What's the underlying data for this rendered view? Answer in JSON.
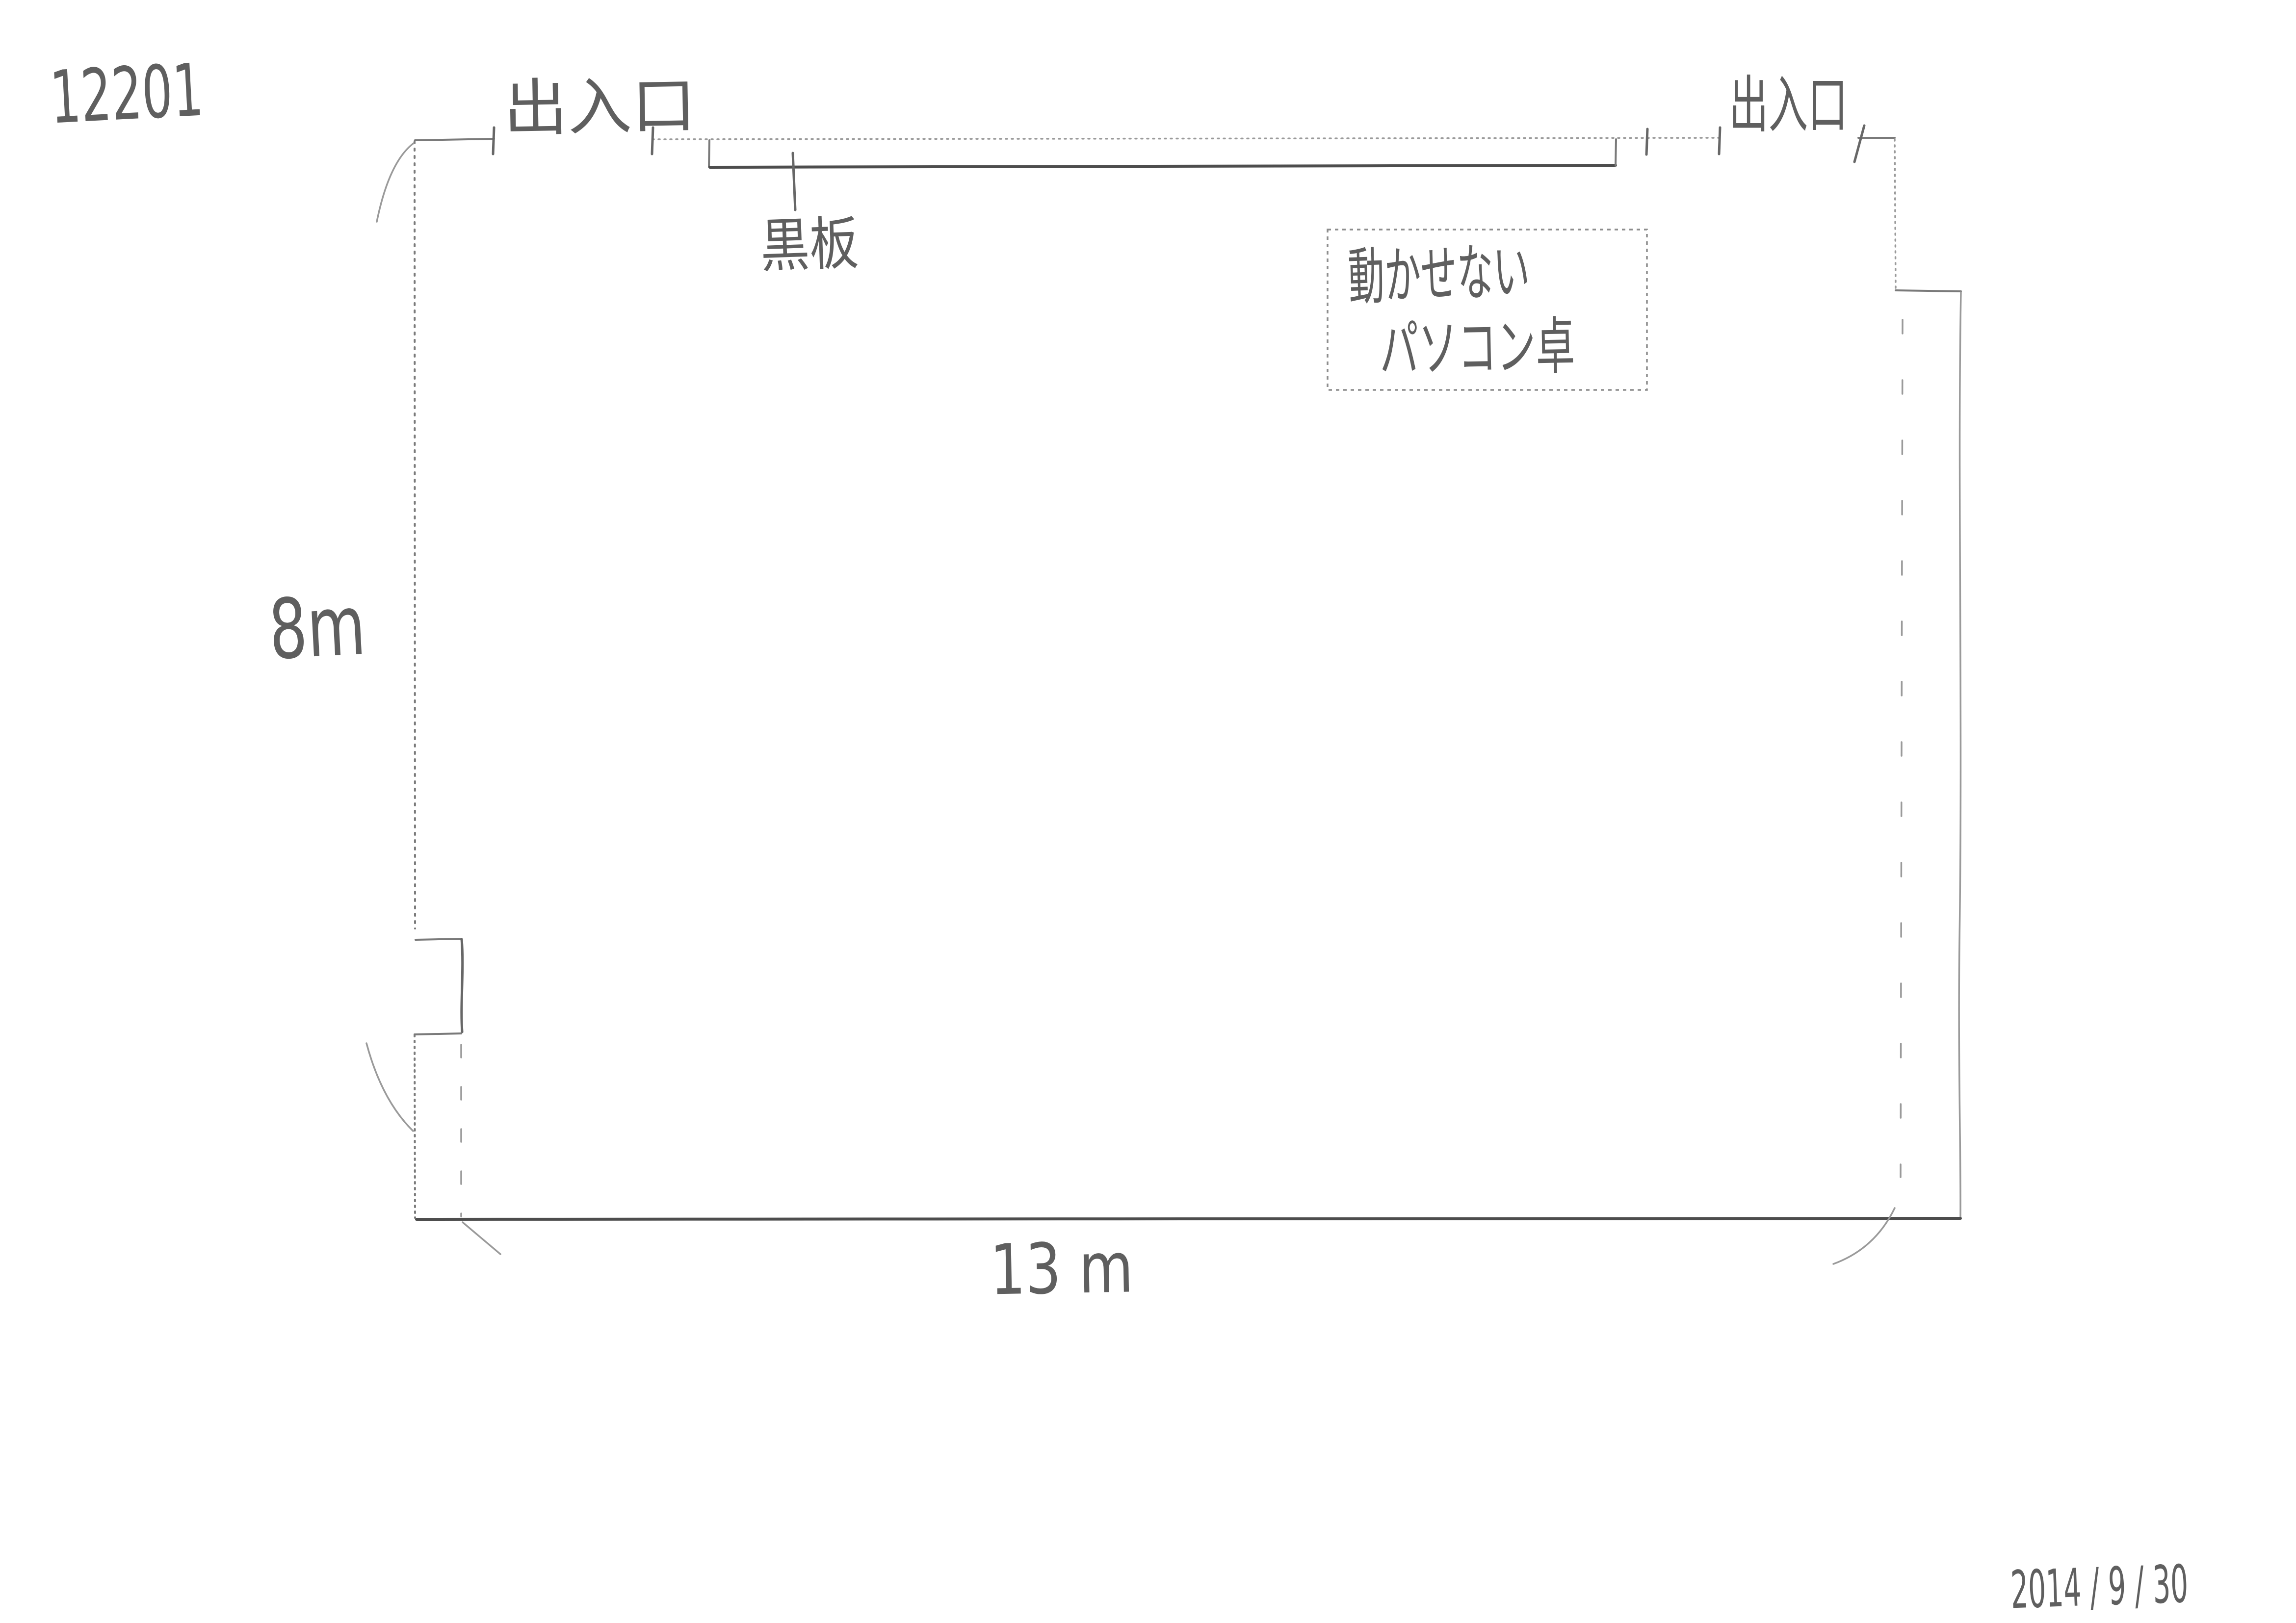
{
  "page": {
    "background": "#ffffff",
    "pencil_color": "#7a7a7a",
    "pencil_dark": "#4d4d4d",
    "text_color": "#5f5f5f"
  },
  "annotations": {
    "room_number": "12201",
    "date": "2014 / 9 / 30"
  },
  "floor_plan": {
    "entrance_left_label": "出入口",
    "entrance_right_label": "出入口",
    "blackboard_label": "黒板",
    "fixed_pc_desk_line1": "動かせない",
    "fixed_pc_desk_line2": "パソコン卓",
    "dimension_height": "8m",
    "dimension_width": "13 m"
  }
}
